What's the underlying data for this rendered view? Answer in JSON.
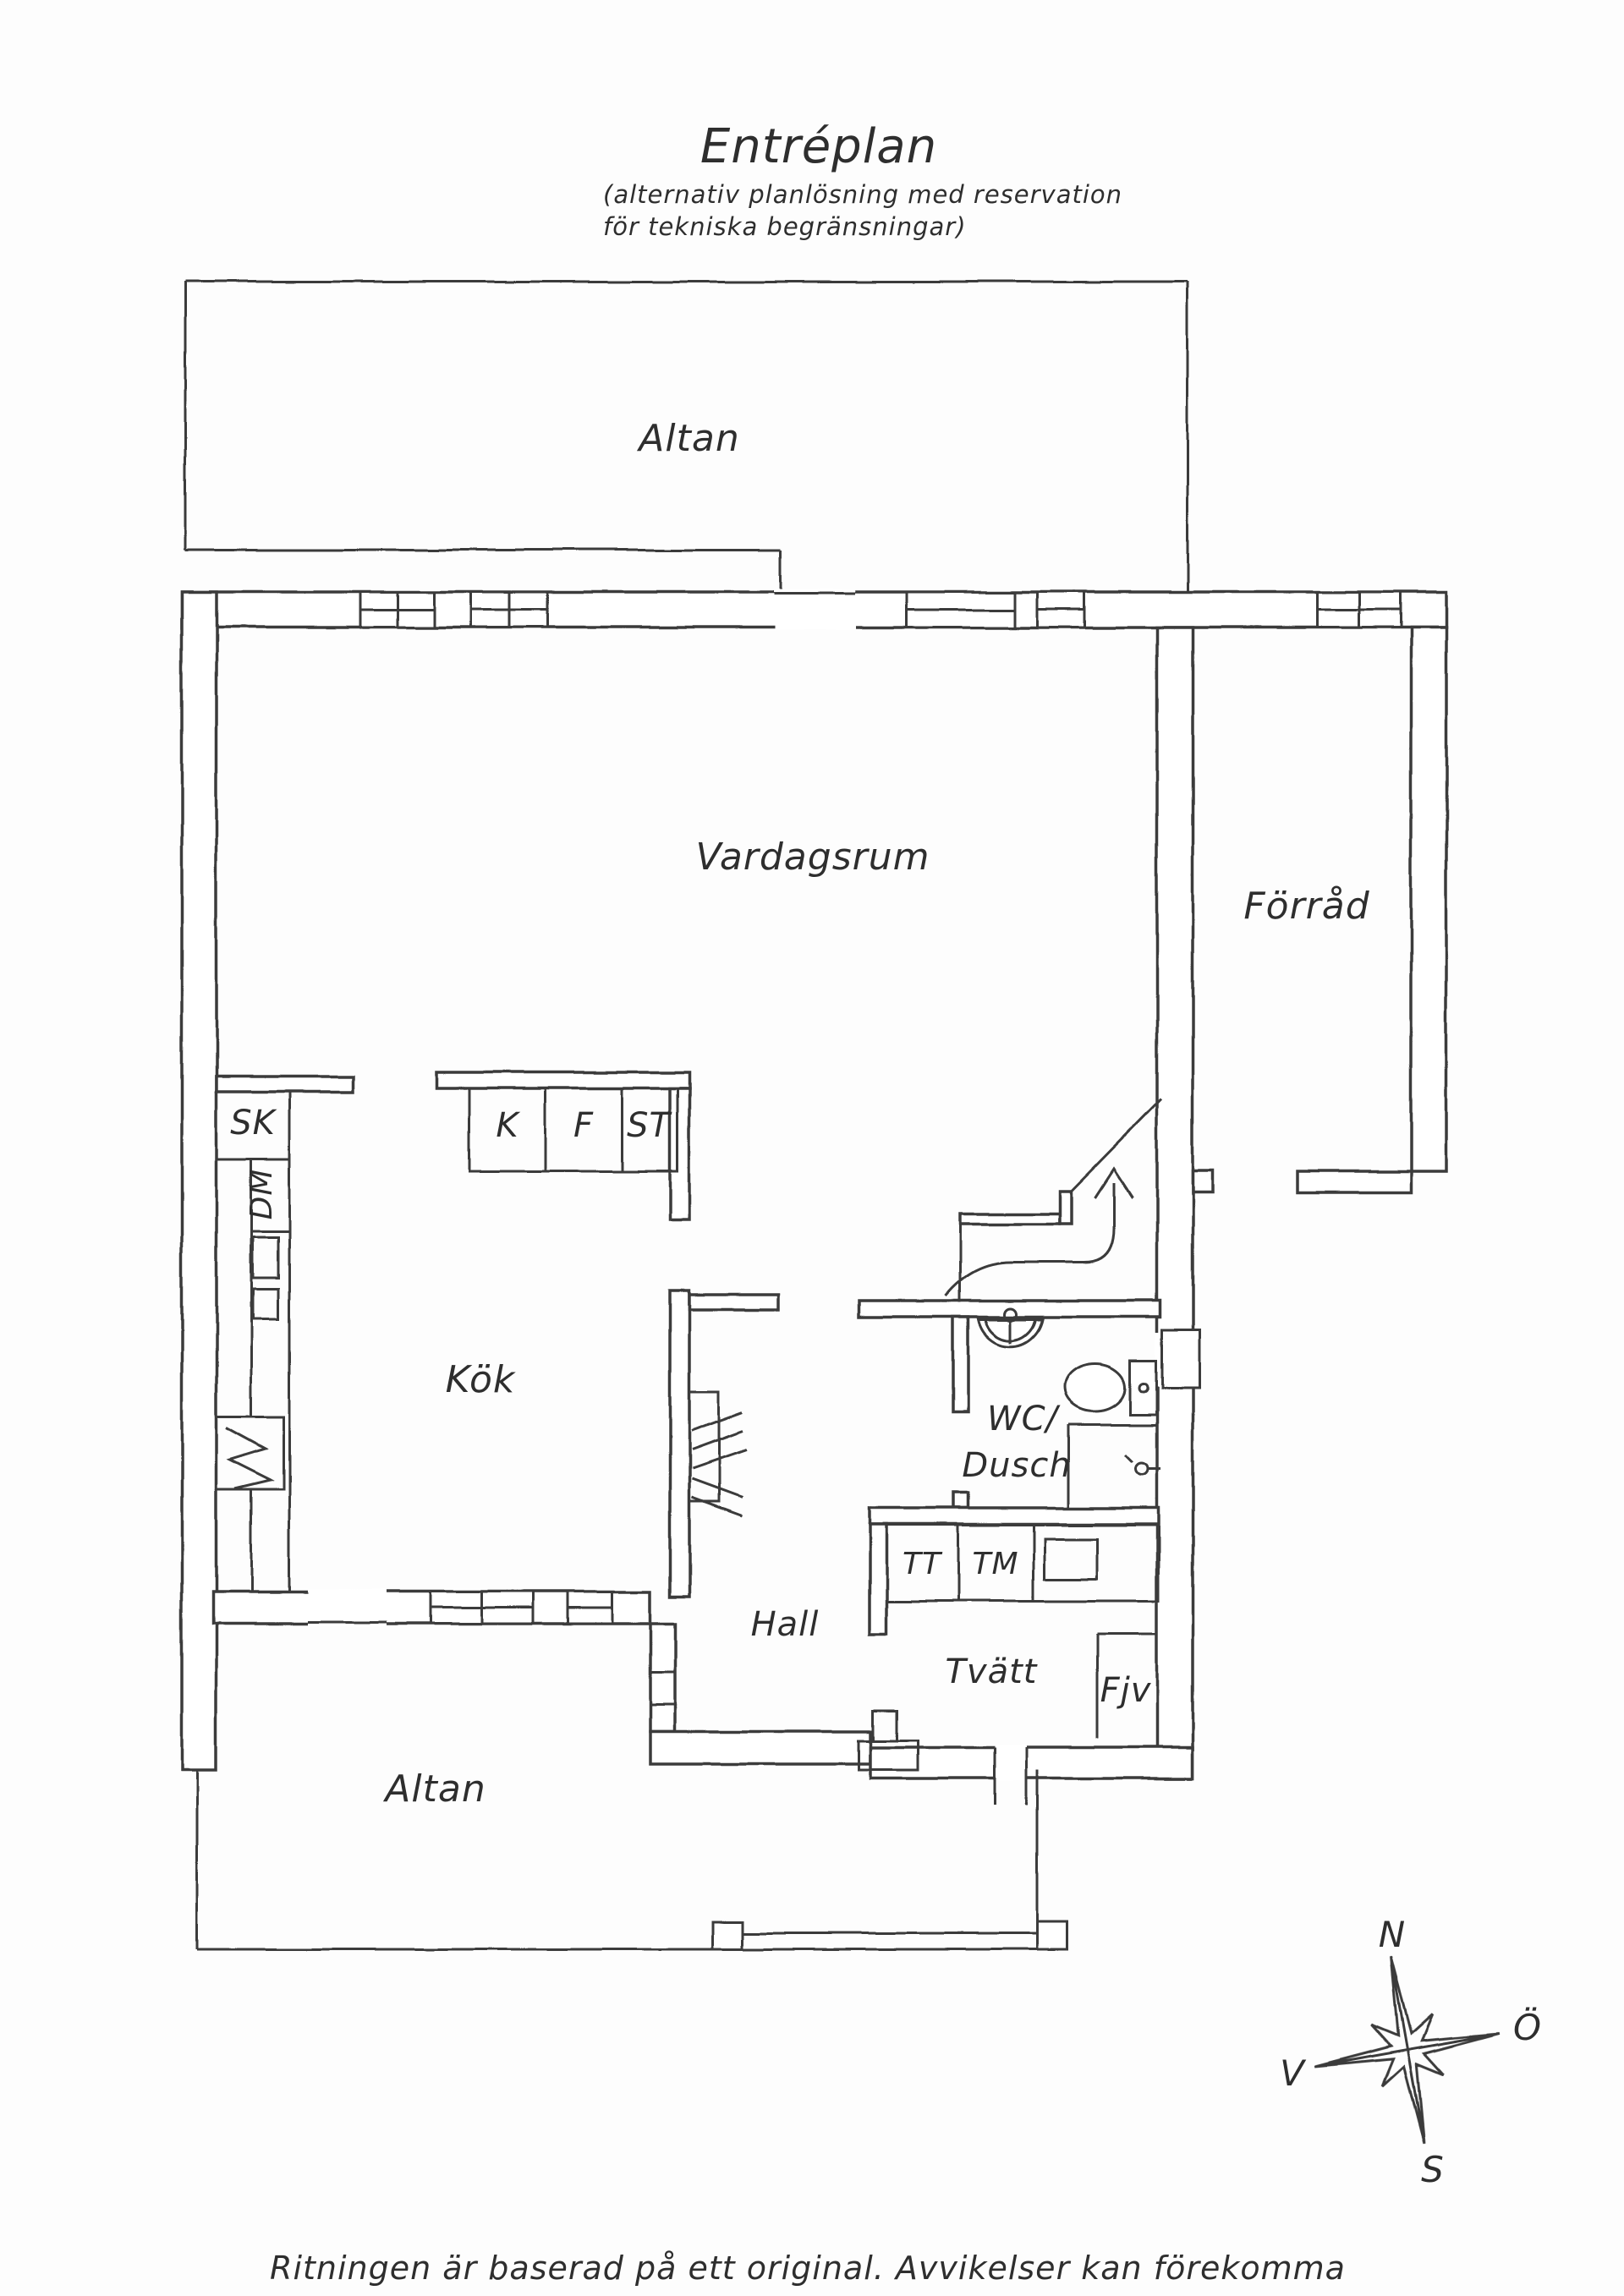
{
  "page": {
    "background": "#fdfdfd",
    "ink_color": "#3a3a3a",
    "text_color": "#2e2e2e"
  },
  "header": {
    "title": "Entréplan",
    "subtitle_line1": "(alternativ planlösning med reservation",
    "subtitle_line2": "för tekniska begränsningar)"
  },
  "rooms": {
    "altan_top": "Altan",
    "vardagsrum": "Vardagsrum",
    "forrad": "Förråd",
    "kok": "Kök",
    "hall": "Hall",
    "wc_line1": "WC/",
    "wc_line2": "Dusch",
    "tvatt": "Tvätt",
    "altan_bottom": "Altan"
  },
  "fixtures": {
    "sk": "SK",
    "dm": "DM",
    "k": "K",
    "f": "F",
    "st": "ST",
    "tt": "TT",
    "tm": "TM",
    "fjv": "Fjv"
  },
  "compass": {
    "north": "N",
    "east": "Ö",
    "west": "V",
    "south": "S"
  },
  "footer": {
    "note": "Ritningen är baserad på ett original. Avvikelser kan förekomma"
  }
}
